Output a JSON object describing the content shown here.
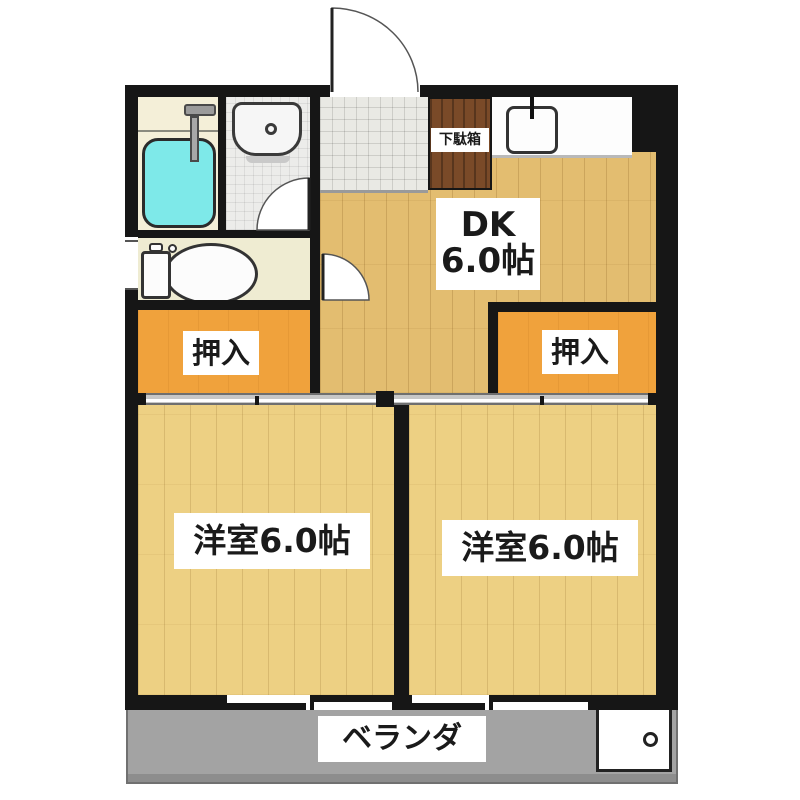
{
  "floor_plan": {
    "dk": {
      "name": "DK",
      "size": "6.0帖"
    },
    "bedroom_left": {
      "label": "洋室6.0帖"
    },
    "bedroom_right": {
      "label": "洋室6.0帖"
    },
    "closet_left": {
      "label": "押入"
    },
    "closet_right": {
      "label": "押入"
    },
    "shoe_cabinet": {
      "label": "下駄箱"
    },
    "veranda": {
      "label": "ベランダ"
    }
  },
  "colors": {
    "wall": "#161616",
    "wood_floor_dk": "#e3bd70",
    "wood_floor_bedroom": "#edd083",
    "closet_orange": "#f0a23c",
    "bathtub_cyan": "#7ee9e9",
    "shoe_cabinet_brown": "#7a4a28",
    "veranda_gray": "#a3a3a3",
    "entrance_tile_gray": "#e9e9e4",
    "bathroom_cream": "#f4efd8"
  }
}
